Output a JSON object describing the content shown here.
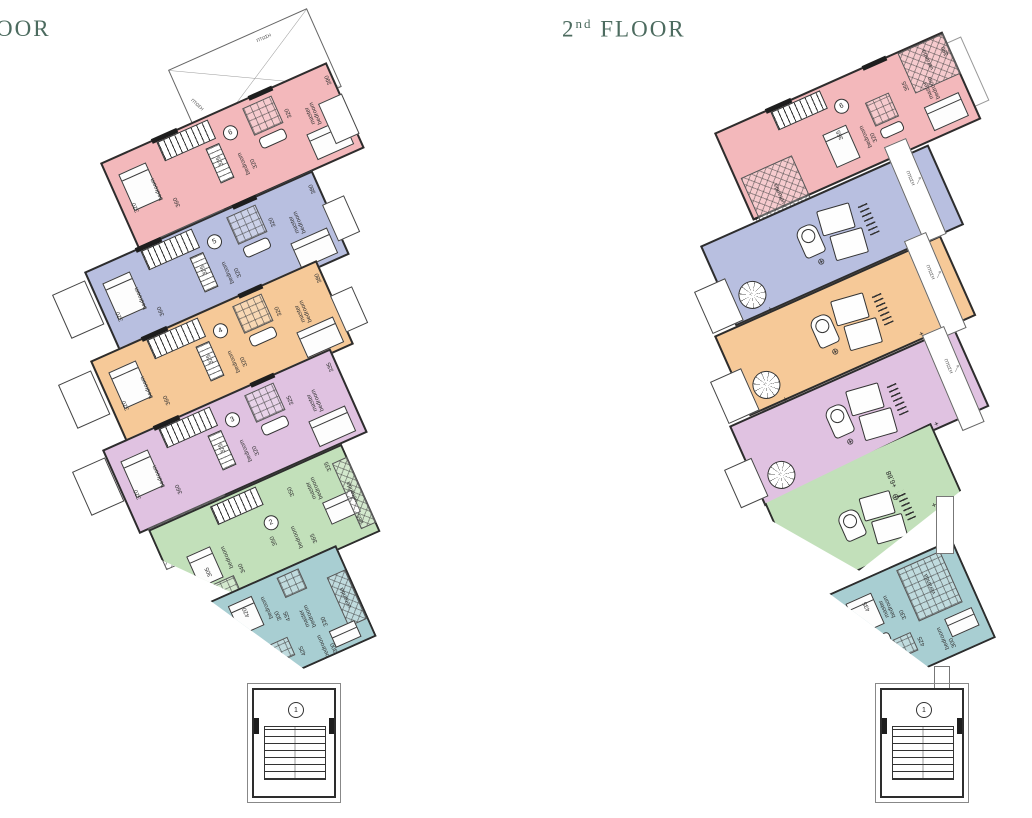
{
  "titles": {
    "left_fragment": "OOR",
    "right": {
      "number": "2",
      "ordinal": "nd",
      "word": "FLOOR"
    }
  },
  "palette": {
    "pink": "#f3b8bb",
    "lavender": "#b8bfe0",
    "orange": "#f6c998",
    "purple": "#e0c2e1",
    "green": "#c2e0ba",
    "teal": "#a8ced2",
    "wall": "#2d2d2d",
    "title": "#4c6b5f"
  },
  "labels": {
    "veranda": "veranda",
    "fall": "ΠΤΩΣΗ",
    "plus": "+"
  },
  "floor1": {
    "units": [
      {
        "circle": "6",
        "color": "pink",
        "room1": {
          "label": "bedroom",
          "d1": "320",
          "d2": "360"
        },
        "room2": {
          "label": "bedroom",
          "d1": "325",
          "d2": "320"
        },
        "room3": {
          "label": "master bedroom",
          "d1": "320",
          "d2": "390"
        },
        "veranda": {
          "label": "veranda",
          "dim": ""
        }
      },
      {
        "circle": "5",
        "color": "lavender",
        "room1": {
          "label": "bedroom",
          "d1": "320",
          "d2": "360"
        },
        "room2": {
          "label": "bedroom",
          "d1": "325",
          "d2": "320"
        },
        "room3": {
          "label": "master bedroom",
          "d1": "320",
          "d2": "380"
        },
        "veranda": {
          "label": "veranda",
          "dim": ""
        }
      },
      {
        "circle": "4",
        "color": "orange",
        "room1": {
          "label": "bedroom",
          "d1": "320",
          "d2": "360"
        },
        "room2": {
          "label": "bedroom",
          "d1": "325",
          "d2": "320"
        },
        "room3": {
          "label": "master bedroom",
          "d1": "320",
          "d2": "380"
        },
        "veranda": {
          "label": "veranda",
          "dim": ""
        }
      },
      {
        "circle": "3",
        "color": "purple",
        "room1": {
          "label": "bedroom",
          "d1": "320",
          "d2": "360"
        },
        "room2": {
          "label": "bedroom",
          "d1": "325",
          "d2": "320"
        },
        "room3": {
          "label": "master bedroom",
          "d1": "325",
          "d2": "335"
        },
        "veranda": {
          "label": "veranda",
          "dim": "360"
        }
      },
      {
        "circle": "2",
        "color": "green",
        "room1": {
          "label": "bedroom",
          "d1": "305",
          "d2": "340"
        },
        "room2": {
          "label": "bedroom",
          "d1": "350",
          "d2": "365"
        },
        "room3": {
          "label": "master bedroom",
          "d1": "350",
          "d2": "335"
        },
        "veranda": {
          "label": "veranda",
          "dim": "365"
        }
      },
      {
        "circle": "",
        "color": "teal",
        "room1": {
          "label": "bedroom",
          "d1": "420",
          "d2": "300"
        },
        "room2": {
          "label": "master bedroom",
          "d1": "435",
          "d2": "330"
        },
        "room3": {
          "label": "bedroom",
          "d1": "425",
          "d2": "300"
        },
        "veranda": {
          "label": "veranda",
          "dim": "330"
        }
      }
    ]
  },
  "floor2": {
    "unit6": {
      "circle": "6",
      "room2": {
        "label": "bedroom",
        "d1": "365",
        "d2": "320"
      },
      "room3": {
        "label": "master bedroom",
        "d1": "355",
        "d2": "390"
      },
      "veranda_left": "veranda",
      "veranda_right": "veranda"
    },
    "terraces": [
      {
        "color": "lavender",
        "level": "+6.99"
      },
      {
        "color": "orange",
        "level": "+6.99"
      },
      {
        "color": "purple",
        "level": "+6.99"
      },
      {
        "color": "green",
        "level": "+6.88"
      }
    ],
    "unit1": {
      "room1": {
        "label": "master bedroom",
        "d1": "435",
        "d2": "330"
      },
      "room2": {
        "label": "bedroom",
        "d1": "425",
        "d2": "300"
      },
      "veranda": "veranda"
    }
  },
  "stair_tower": {
    "circle": "1"
  }
}
